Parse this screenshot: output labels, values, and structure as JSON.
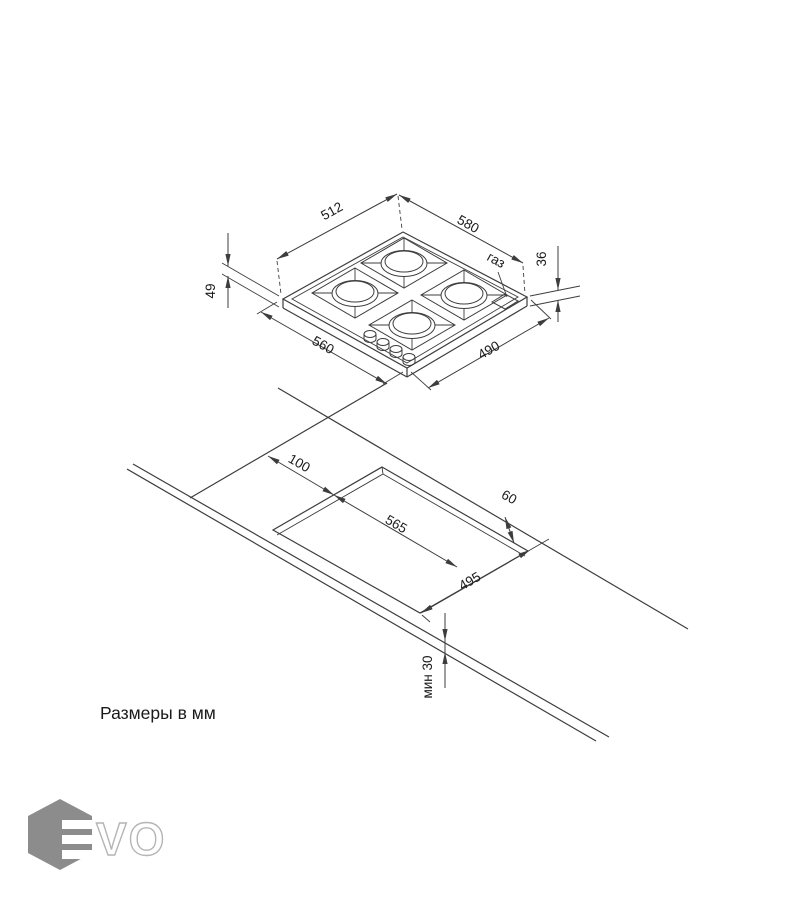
{
  "page": {
    "units_note": "Размеры в мм"
  },
  "logo": {
    "name": "EVO",
    "outline_text": "VO"
  },
  "hob_view": {
    "dim_top_left": "512",
    "dim_top_right": "580",
    "dim_bottom_left": "560",
    "dim_bottom_right": "490",
    "dim_height_left": "49",
    "dim_height_right": "36",
    "gas_label": "газ"
  },
  "cutout_view": {
    "dim_left_offset": "100",
    "dim_cutout_width": "565",
    "dim_cutout_depth": "495",
    "dim_back_clearance": "60",
    "dim_front_min": "мин 30"
  }
}
